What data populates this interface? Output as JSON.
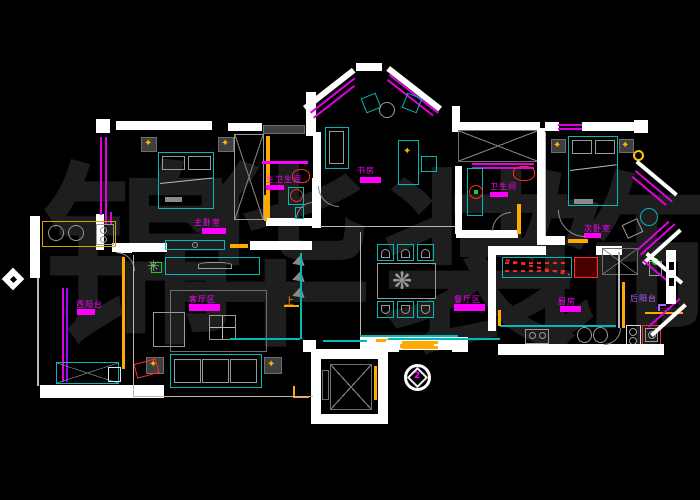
{
  "app": {
    "type": "cad-floor-plan",
    "background": "#000000"
  },
  "watermark": {
    "text": "锦华装饰",
    "chars": [
      "锦",
      "华",
      "装",
      "饰"
    ]
  },
  "rooms": {
    "master_bedroom": {
      "label": "主卧室"
    },
    "master_bathroom": {
      "label": "主卫生间"
    },
    "study": {
      "label": "书房"
    },
    "bathroom": {
      "label": "卫生间"
    },
    "second_bedroom": {
      "label": "次卧室"
    },
    "west_balcony": {
      "label": "西阳台"
    },
    "living_area": {
      "label": "客厅区"
    },
    "dining_area": {
      "label": "餐厅区"
    },
    "kitchen": {
      "label": "厨房"
    },
    "rear_balcony": {
      "label": "后阳台"
    }
  },
  "annotations": {
    "direction_up": "上",
    "section_marker": "2"
  },
  "icons": {
    "lamp": "✦",
    "plant": "✳",
    "centerpiece": "❋"
  },
  "colors": {
    "wall": "#ffffff",
    "furniture": "#00b9b9",
    "label": "#ff00ff",
    "window": "#e000e0",
    "accent": "#ffaa00",
    "fixture": "#ff2222",
    "plant": "#22cc22",
    "balcony_label": "#b266ff",
    "watermark": "#1e1e1e"
  }
}
